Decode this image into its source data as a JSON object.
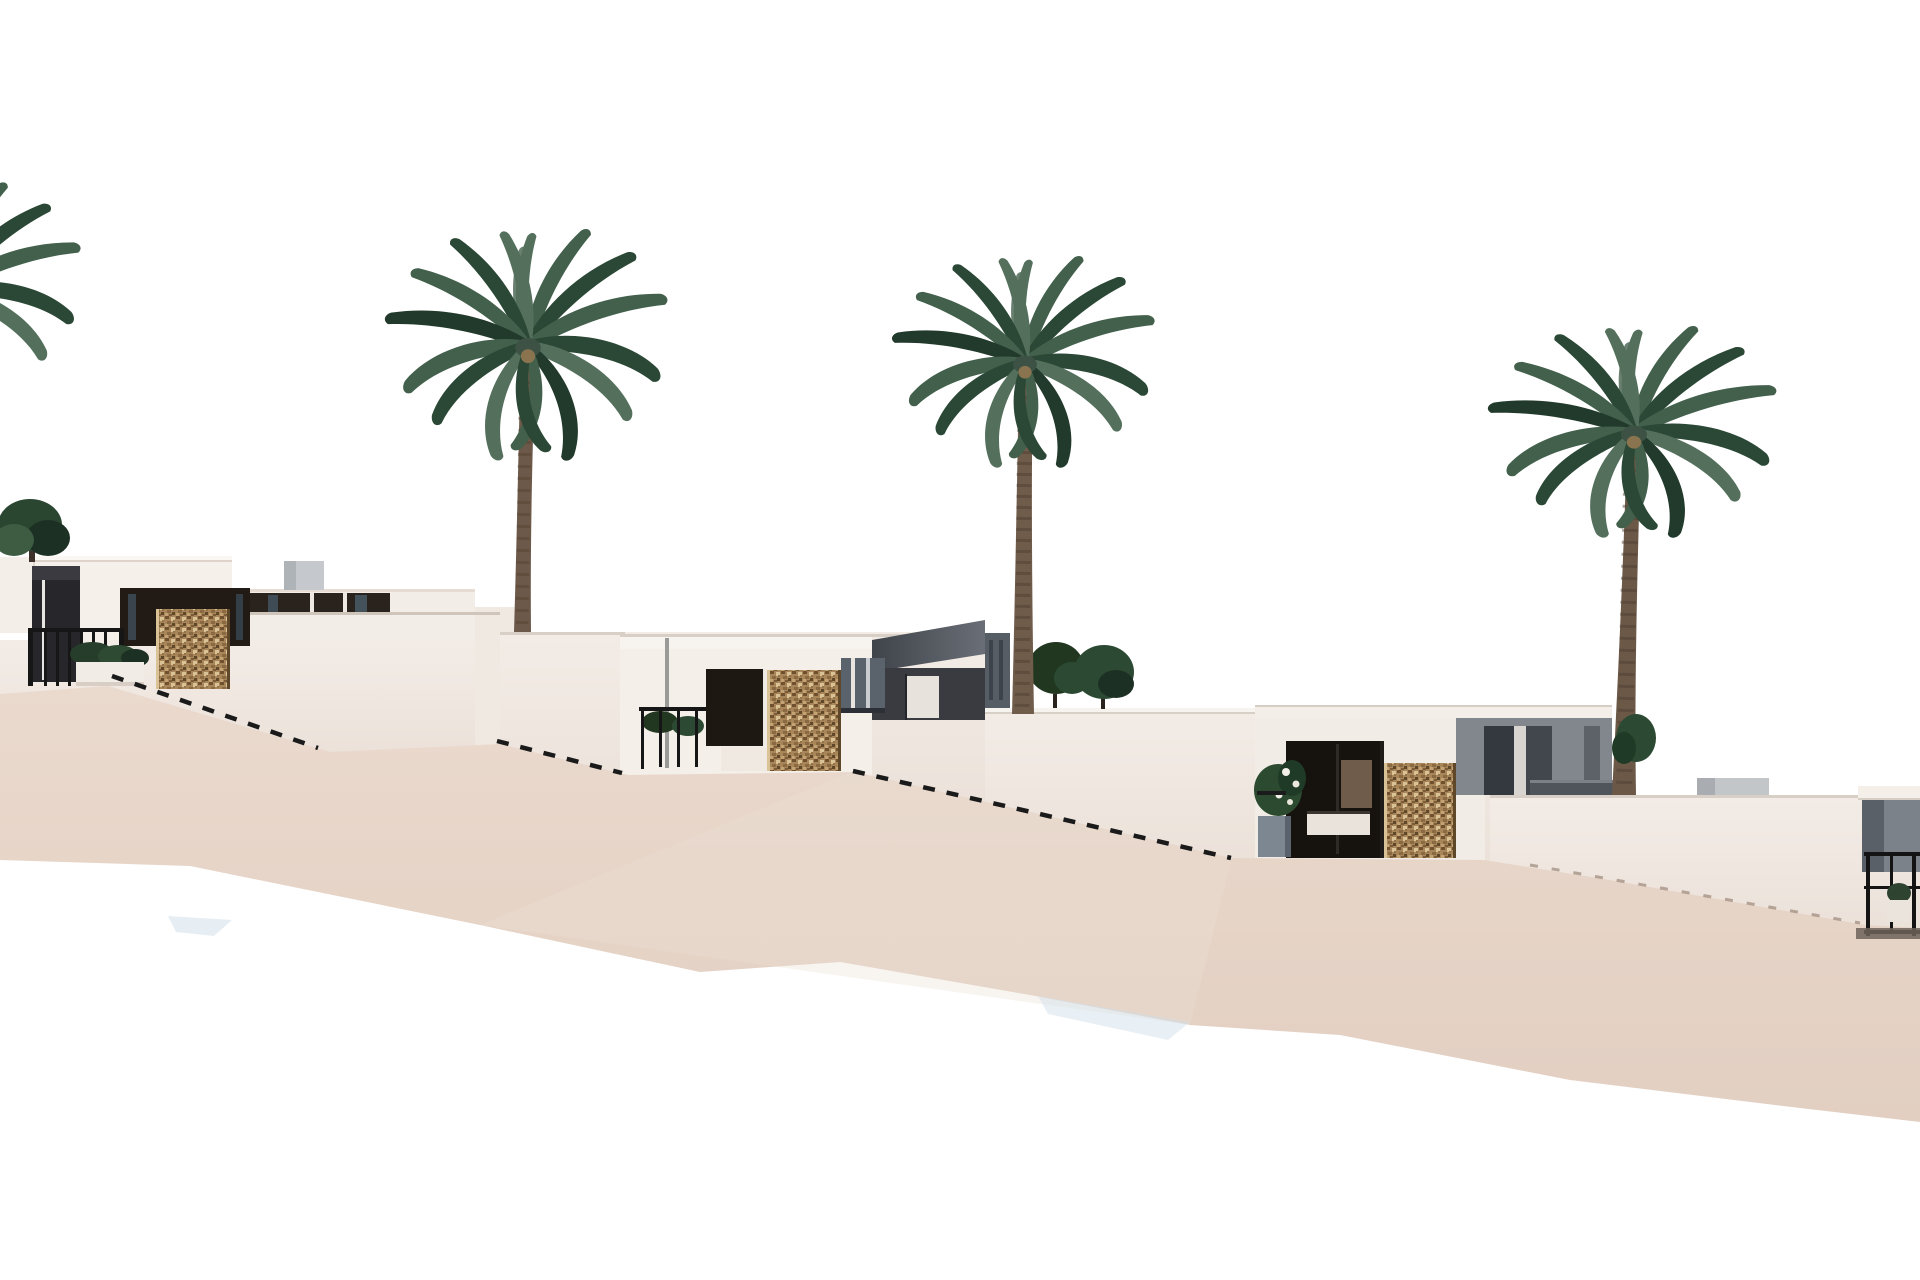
{
  "scene": {
    "description": "3D architectural rendering: a hillside row of modern white flat-roof villas stepping down a sandy slope from left to right, with four tall palm trees, gabion stone entry pillars, dark glazed openings, black metal railings, planters and dashed stair handrails, on a plain white background",
    "type": "exterior-render",
    "background": "white",
    "terrain": "beige sand slope descending to the right",
    "villas": [
      {
        "id": "left-villa",
        "features": [
          "two-story white block",
          "one-story wing with dark window band",
          "dark entry column",
          "gabion stone pillar",
          "black entry gate",
          "hedge and white planter",
          "rooftop box"
        ]
      },
      {
        "id": "middle-villa",
        "features": [
          "white parapet",
          "dark entry recess",
          "gabion stone pillar",
          "black railing with plants",
          "gray glazed band",
          "dark sloped roof section",
          "white door"
        ]
      },
      {
        "id": "right-villa",
        "features": [
          "white roof slab",
          "dark recessed porch",
          "planter with white flowers",
          "gabion stone pillar",
          "gray side wall with door recesses"
        ]
      },
      {
        "id": "far-right-villa",
        "features": [
          "partial view at image edge",
          "gray wall",
          "black railing",
          "white planter",
          "ground shadow"
        ]
      }
    ],
    "palms": [
      {
        "id": "palm-1",
        "note": "partially visible at far left edge"
      },
      {
        "id": "palm-2",
        "note": "tall palm over left villa"
      },
      {
        "id": "palm-3",
        "note": "tall palm over middle villa"
      },
      {
        "id": "palm-4",
        "note": "tall palm over right terrace"
      }
    ],
    "stairs": [
      {
        "id": "handrail-1",
        "note": "dashed descending rail below left villa"
      },
      {
        "id": "handrail-2",
        "note": "short dashed rail left of middle villa"
      },
      {
        "id": "handrail-3",
        "note": "long dashed rail from middle villa to right villa"
      },
      {
        "id": "handrail-4",
        "note": "faint dashed terrace edge at lower right"
      }
    ]
  },
  "colors": {
    "sky": "#ffffff",
    "sand_top": "#ead9cd",
    "sand_bottom": "#e2cfc2",
    "wall_face": "#f2ebe5",
    "wall_face_dark": "#e9dfd7",
    "villa_white": "#f5f0ea",
    "edge_line": "#d8cfc6",
    "glazing_dark": "#221b15",
    "window_band": "#2a221c",
    "gray_wall": "#7b828a",
    "gray_wall_dark": "#41454c",
    "stone_base": "#a8865a",
    "stone_dark": "#6f5130",
    "stone_light": "#d9c295",
    "railing_black": "#161616",
    "palm_green_dark": "#2b4836",
    "palm_green_mid": "#42604b",
    "palm_green_light": "#6a8070",
    "trunk_brown": "#6d594a",
    "shadow_blue": "#cfdde8",
    "shadow_warm": "#6e6359"
  }
}
